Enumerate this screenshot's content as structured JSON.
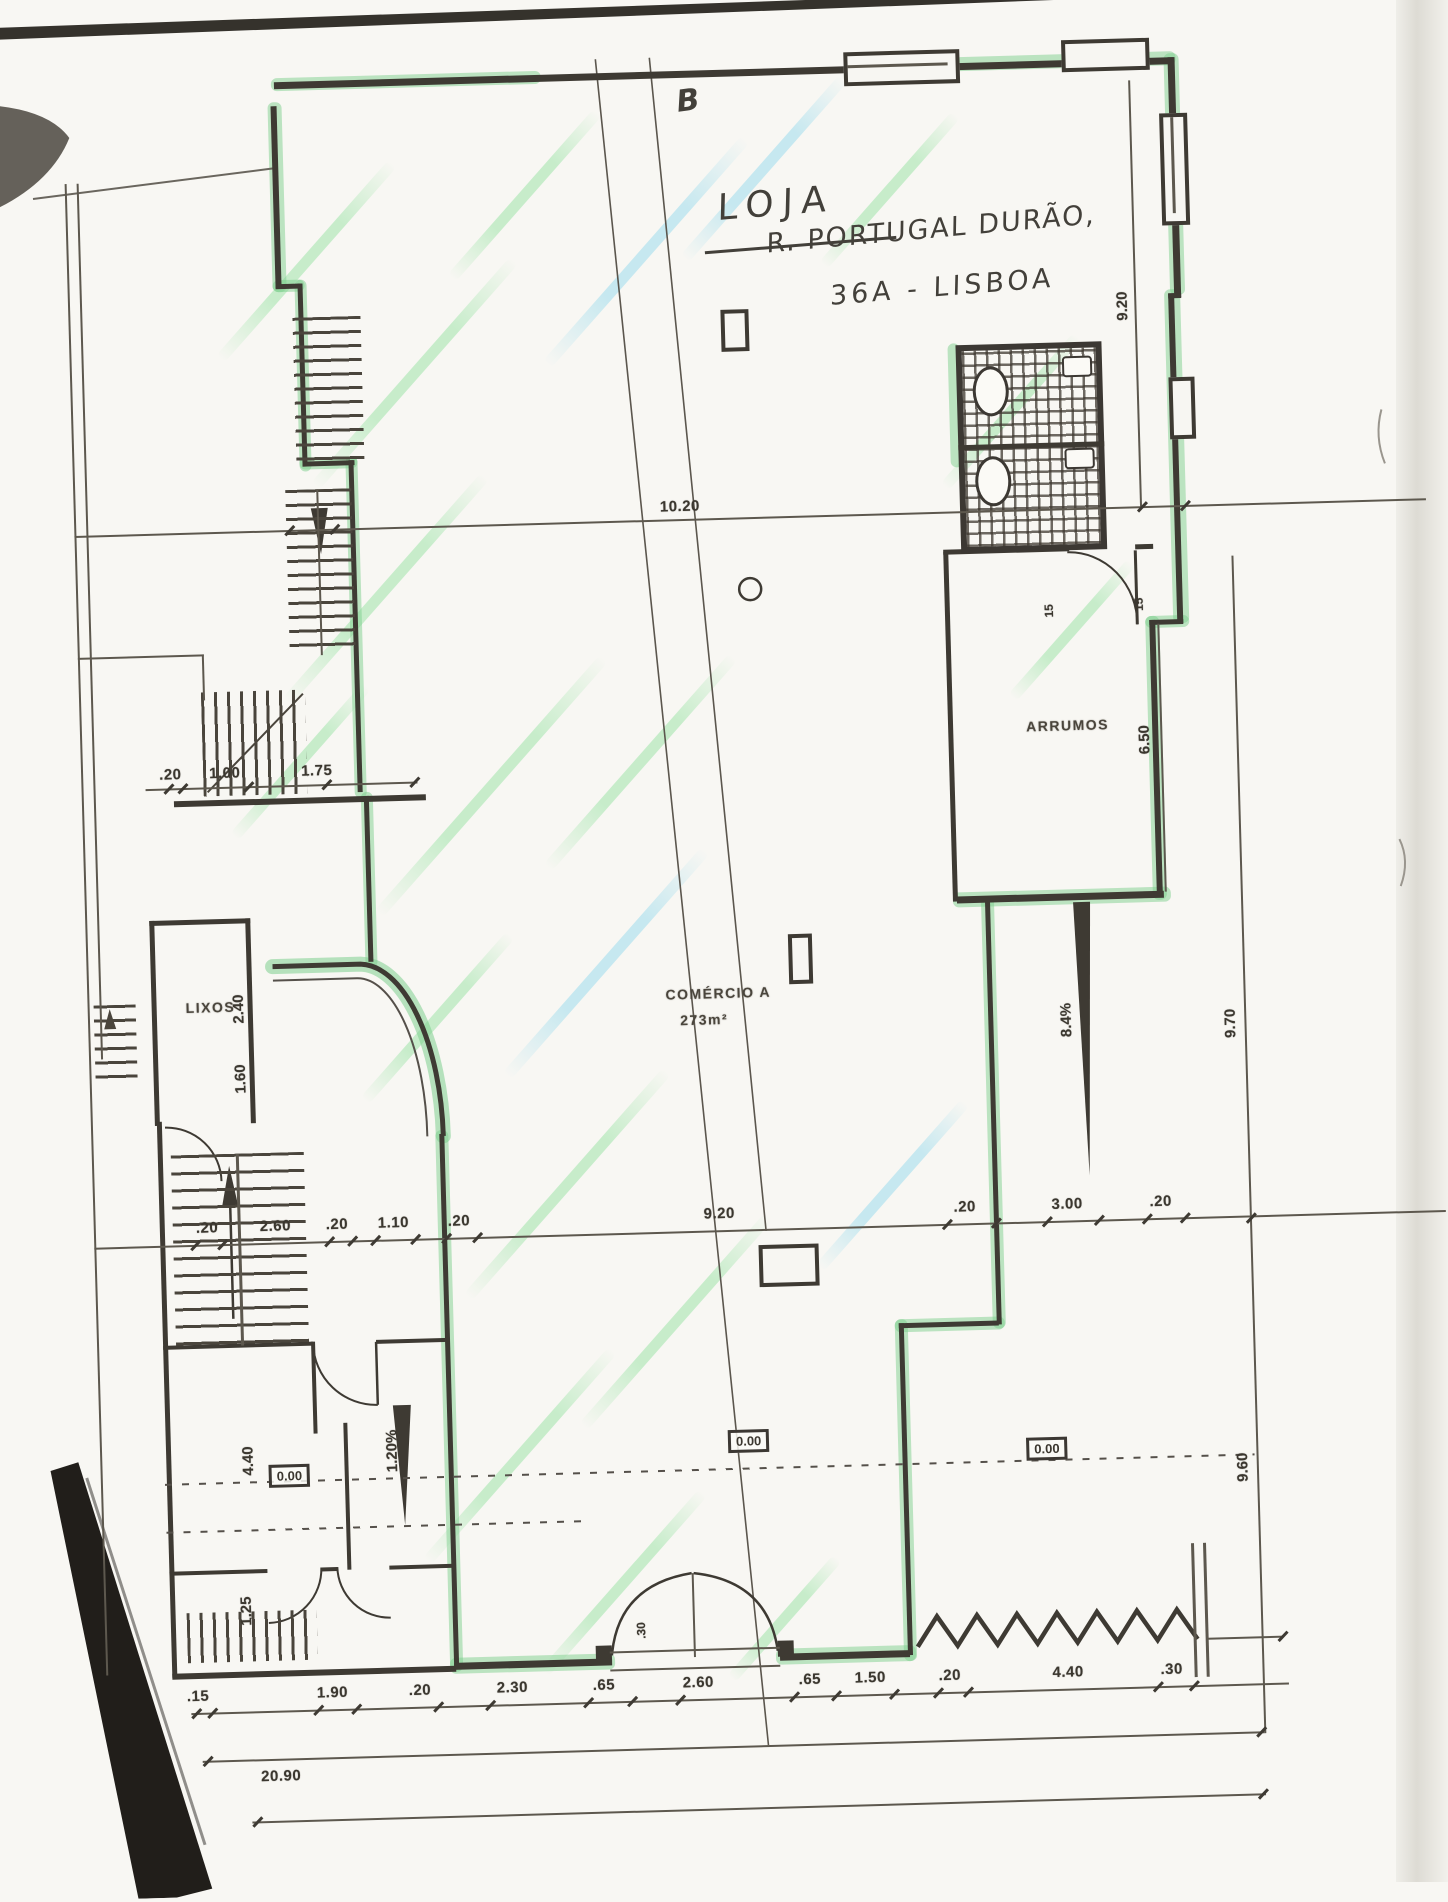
{
  "annotations": {
    "section": "B",
    "title": "LOJA",
    "address1": "R. PORTUGAL DURÃO,",
    "address2": "36A - LISBOA"
  },
  "labels": {
    "storage": "ARRUMOS",
    "trash": "LIXOS",
    "shop": "COMÉRCIO A",
    "shop_area": "273m²"
  },
  "levels": {
    "left": "0.00",
    "center": "0.00",
    "right": "0.00"
  },
  "ramps": {
    "left": "1.20%",
    "right": "8.4%"
  },
  "dims": {
    "top_total": "10.20",
    "upper_left": [
      ".20",
      "1.00",
      "1.75"
    ],
    "right_upper": "9.20",
    "storage_side": "6.50",
    "door_left": "15",
    "door_right": "15",
    "trash_a": "2.40",
    "trash_b": "1.60",
    "mid": [
      ".20",
      "2.60",
      ".20",
      "1.10",
      ".20",
      "9.20",
      ".20",
      "3.00",
      ".20"
    ],
    "stair_h": "4.40",
    "lower_left_h": "1.25",
    "right_mid": "9.70",
    "right_low": "9.60",
    "bottom": [
      ".15",
      "1.90",
      ".20",
      "2.30",
      ".65",
      "2.60",
      ".65",
      "1.50",
      ".20",
      "4.40",
      ".30"
    ],
    "jamb": ".30",
    "total": "20.90"
  }
}
